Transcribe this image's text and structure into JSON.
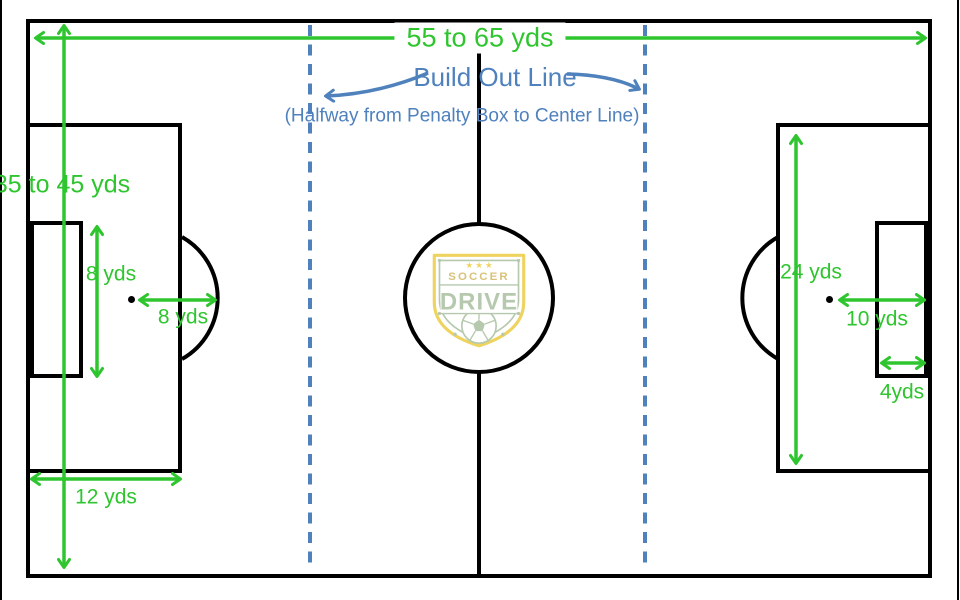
{
  "colors": {
    "field_line": "#000000",
    "dimension_green": "#2ec52e",
    "annotation_blue": "#4f81bd",
    "logo_gold": "#efd35f",
    "logo_text_gold": "#d8c37a",
    "logo_sage": "#b6c9ae"
  },
  "dimensions": {
    "field_length": "55 to 65 yds",
    "field_width": "35 to 45 yds",
    "left_goal_area_depth": "8 yds",
    "left_penalty_spot_distance": "8 yds",
    "left_penalty_box_width": "12 yds",
    "right_penalty_box_length": "24 yds",
    "right_penalty_spot_distance": "10 yds",
    "right_goal_area_width": "4yds"
  },
  "build_out": {
    "title": "Build Out Line",
    "subtitle": "(Halfway from Penalty Box to Center Line)"
  },
  "logo": {
    "stars": "★ ★ ★",
    "top_text": "SOCCER",
    "main_text": "DRIVE"
  }
}
